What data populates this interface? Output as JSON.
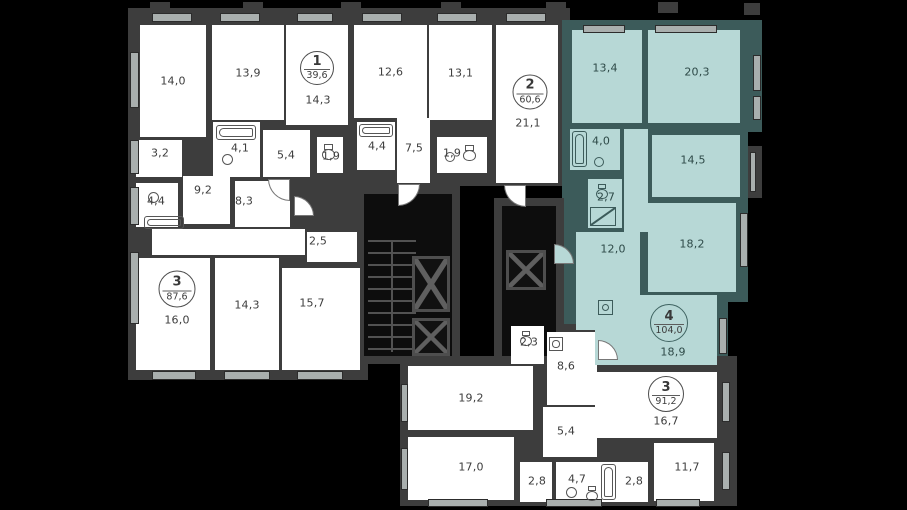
{
  "meta": {
    "description": "Residential floor plan with five apartments; apartment 4 (104.0 m2) highlighted"
  },
  "palette": {
    "background": "#000000",
    "wall": "#3d3d3d",
    "wall_teal": "#3c5b5a",
    "room_white": "#ffffff",
    "room_teal": "#b7d8d6",
    "label_text": "#3d3d3d",
    "label_text_teal": "#2e4a48",
    "window_mark": "#a9afae"
  },
  "units": [
    {
      "number": "1",
      "area": "39,6",
      "cx": 317,
      "cy": 68,
      "d": 34,
      "fill": "white"
    },
    {
      "number": "2",
      "area": "60,6",
      "cx": 530,
      "cy": 92,
      "d": 35,
      "fill": "white"
    },
    {
      "number": "3",
      "area": "87,6",
      "cx": 177,
      "cy": 289,
      "d": 37,
      "fill": "white"
    },
    {
      "number": "4",
      "area": "104,0",
      "cx": 669,
      "cy": 323,
      "d": 38,
      "fill": "teal"
    },
    {
      "number": "3",
      "area": "91,2",
      "cx": 666,
      "cy": 394,
      "d": 36,
      "fill": "white"
    }
  ],
  "rooms": [
    {
      "label": "14,0",
      "x": 140,
      "y": 25,
      "w": 66,
      "h": 112,
      "fill": "white"
    },
    {
      "label": "13,9",
      "x": 212,
      "y": 25,
      "w": 72,
      "h": 95,
      "fill": "white"
    },
    {
      "label": "14,3",
      "x": 286,
      "y": 25,
      "w": 62,
      "h": 100,
      "fill": "white",
      "lx": 318,
      "ly": 100
    },
    {
      "label": "12,6",
      "x": 354,
      "y": 25,
      "w": 73,
      "h": 93,
      "fill": "white"
    },
    {
      "label": "13,1",
      "x": 429,
      "y": 25,
      "w": 63,
      "h": 95,
      "fill": "white"
    },
    {
      "label": "21,1",
      "x": 496,
      "y": 25,
      "w": 62,
      "h": 158,
      "fill": "white",
      "lx": 528,
      "ly": 123
    },
    {
      "label": "3,2",
      "x": 136,
      "y": 140,
      "w": 46,
      "h": 37,
      "fill": "white",
      "lx": 160,
      "ly": 153
    },
    {
      "label": "4,1",
      "x": 213,
      "y": 122,
      "w": 47,
      "h": 55,
      "fill": "white",
      "lx": 240,
      "ly": 148
    },
    {
      "label": "5,4",
      "x": 263,
      "y": 130,
      "w": 47,
      "h": 47,
      "fill": "white",
      "lx": 286,
      "ly": 155
    },
    {
      "label": "1,9",
      "x": 317,
      "y": 137,
      "w": 26,
      "h": 36,
      "fill": "white",
      "lx": 331,
      "ly": 156
    },
    {
      "label": "4,4",
      "x": 357,
      "y": 122,
      "w": 38,
      "h": 48,
      "fill": "white",
      "lx": 377,
      "ly": 146
    },
    {
      "label": "7,5",
      "x": 397,
      "y": 118,
      "w": 33,
      "h": 65,
      "fill": "white",
      "lx": 414,
      "ly": 148
    },
    {
      "label": "1,9",
      "x": 437,
      "y": 137,
      "w": 50,
      "h": 36,
      "fill": "white",
      "lx": 452,
      "ly": 153
    },
    {
      "label": "4,4",
      "x": 136,
      "y": 183,
      "w": 42,
      "h": 44,
      "fill": "white",
      "lx": 156,
      "ly": 201
    },
    {
      "label": "9,2",
      "x": 183,
      "y": 176,
      "w": 47,
      "h": 48,
      "fill": "white",
      "lx": 203,
      "ly": 190
    },
    {
      "label": "8,3",
      "x": 235,
      "y": 181,
      "w": 55,
      "h": 46,
      "fill": "white",
      "lx": 244,
      "ly": 201
    },
    {
      "label": "",
      "x": 152,
      "y": 229,
      "w": 153,
      "h": 26,
      "fill": "white"
    },
    {
      "label": "2,5",
      "x": 307,
      "y": 232,
      "w": 50,
      "h": 30,
      "fill": "white",
      "lx": 318,
      "ly": 241
    },
    {
      "label": "16,0",
      "x": 136,
      "y": 258,
      "w": 74,
      "h": 112,
      "fill": "white",
      "lx": 177,
      "ly": 320
    },
    {
      "label": "14,3",
      "x": 215,
      "y": 258,
      "w": 64,
      "h": 112,
      "fill": "white",
      "lx": 247,
      "ly": 305
    },
    {
      "label": "15,7",
      "x": 282,
      "y": 268,
      "w": 78,
      "h": 102,
      "fill": "white",
      "lx": 312,
      "ly": 303
    },
    {
      "label": "2,3",
      "x": 511,
      "y": 326,
      "w": 33,
      "h": 38,
      "fill": "white",
      "lx": 529,
      "ly": 342
    },
    {
      "label": "8,6",
      "x": 547,
      "y": 332,
      "w": 50,
      "h": 73,
      "fill": "white",
      "lx": 566,
      "ly": 366
    },
    {
      "label": "19,2",
      "x": 408,
      "y": 366,
      "w": 125,
      "h": 64,
      "fill": "white",
      "lx": 471,
      "ly": 398
    },
    {
      "label": "5,4",
      "x": 543,
      "y": 407,
      "w": 54,
      "h": 50,
      "fill": "white",
      "lx": 566,
      "ly": 431
    },
    {
      "label": "16,7",
      "x": 595,
      "y": 372,
      "w": 122,
      "h": 66,
      "fill": "white",
      "lx": 666,
      "ly": 421
    },
    {
      "label": "17,0",
      "x": 408,
      "y": 437,
      "w": 106,
      "h": 63,
      "fill": "white",
      "lx": 471,
      "ly": 467
    },
    {
      "label": "2,8",
      "x": 520,
      "y": 462,
      "w": 32,
      "h": 40,
      "fill": "white",
      "lx": 537,
      "ly": 481
    },
    {
      "label": "4,7",
      "x": 556,
      "y": 462,
      "w": 62,
      "h": 40,
      "fill": "white",
      "lx": 577,
      "ly": 479
    },
    {
      "label": "2,8",
      "x": 618,
      "y": 462,
      "w": 30,
      "h": 40,
      "fill": "white",
      "lx": 634,
      "ly": 481
    },
    {
      "label": "11,7",
      "x": 654,
      "y": 443,
      "w": 60,
      "h": 58,
      "fill": "white",
      "lx": 687,
      "ly": 467
    },
    {
      "label": "13,4",
      "x": 572,
      "y": 30,
      "w": 70,
      "h": 93,
      "fill": "teal",
      "lx": 605,
      "ly": 68
    },
    {
      "label": "20,3",
      "x": 648,
      "y": 30,
      "w": 92,
      "h": 93,
      "fill": "teal",
      "lx": 697,
      "ly": 72
    },
    {
      "label": "4,0",
      "x": 570,
      "y": 129,
      "w": 50,
      "h": 41,
      "fill": "teal",
      "lx": 601,
      "ly": 141
    },
    {
      "label": "14,5",
      "x": 652,
      "y": 135,
      "w": 88,
      "h": 62,
      "fill": "teal",
      "lx": 693,
      "ly": 160
    },
    {
      "label": "",
      "x": 624,
      "y": 129,
      "w": 24,
      "h": 103,
      "fill": "teal"
    },
    {
      "label": "2,7",
      "x": 588,
      "y": 179,
      "w": 34,
      "h": 49,
      "fill": "teal",
      "lx": 606,
      "ly": 197
    },
    {
      "label": "12,0",
      "x": 576,
      "y": 232,
      "w": 64,
      "h": 98,
      "fill": "teal",
      "lx": 613,
      "ly": 249
    },
    {
      "label": "18,2",
      "x": 648,
      "y": 203,
      "w": 88,
      "h": 89,
      "fill": "teal",
      "lx": 692,
      "ly": 244
    },
    {
      "label": "18,9",
      "x": 595,
      "y": 295,
      "w": 122,
      "h": 70,
      "fill": "teal",
      "lx": 673,
      "ly": 352
    }
  ],
  "slabs": [
    {
      "x": 128,
      "y": 8,
      "w": 442,
      "h": 178,
      "fill": "wall"
    },
    {
      "x": 128,
      "y": 172,
      "w": 240,
      "h": 208,
      "fill": "wall"
    },
    {
      "x": 562,
      "y": 20,
      "w": 200,
      "h": 112,
      "fill": "teal"
    },
    {
      "x": 562,
      "y": 130,
      "w": 186,
      "h": 172,
      "fill": "teal"
    },
    {
      "x": 562,
      "y": 295,
      "w": 166,
      "h": 82,
      "fill": "teal"
    },
    {
      "x": 503,
      "y": 324,
      "w": 100,
      "h": 60,
      "fill": "wall"
    },
    {
      "x": 400,
      "y": 356,
      "w": 337,
      "h": 150,
      "fill": "wall"
    },
    {
      "x": 748,
      "y": 146,
      "w": 14,
      "h": 52,
      "fill": "wall"
    },
    {
      "x": 150,
      "y": 2,
      "w": 20,
      "h": 11,
      "fill": "wall"
    },
    {
      "x": 243,
      "y": 2,
      "w": 20,
      "h": 11,
      "fill": "wall"
    },
    {
      "x": 341,
      "y": 2,
      "w": 20,
      "h": 11,
      "fill": "wall"
    },
    {
      "x": 441,
      "y": 2,
      "w": 20,
      "h": 11,
      "fill": "wall"
    },
    {
      "x": 546,
      "y": 2,
      "w": 20,
      "h": 11,
      "fill": "wall"
    },
    {
      "x": 658,
      "y": 2,
      "w": 20,
      "h": 11,
      "fill": "wall"
    },
    {
      "x": 744,
      "y": 3,
      "w": 16,
      "h": 12,
      "fill": "wall"
    }
  ],
  "core": {
    "walls": [
      {
        "x": 356,
        "y": 186,
        "w": 104,
        "h": 178
      },
      {
        "x": 494,
        "y": 198,
        "w": 70,
        "h": 166
      }
    ],
    "inners": [
      {
        "x": 364,
        "y": 194,
        "w": 88,
        "h": 162
      },
      {
        "x": 502,
        "y": 206,
        "w": 54,
        "h": 150
      }
    ],
    "treads": {
      "x": 368,
      "y": 240,
      "w": 48,
      "h": 112
    },
    "tread_divider": {
      "x": 391,
      "y": 240,
      "w": 2,
      "h": 112
    },
    "elevators": [
      {
        "x": 412,
        "y": 256,
        "w": 38,
        "h": 56
      },
      {
        "x": 412,
        "y": 318,
        "w": 38,
        "h": 38
      },
      {
        "x": 506,
        "y": 250,
        "w": 40,
        "h": 40
      }
    ]
  },
  "windows": [
    {
      "x": 152,
      "y": 13,
      "w": 40,
      "h": 9
    },
    {
      "x": 220,
      "y": 13,
      "w": 40,
      "h": 9
    },
    {
      "x": 297,
      "y": 13,
      "w": 36,
      "h": 9
    },
    {
      "x": 362,
      "y": 13,
      "w": 40,
      "h": 9
    },
    {
      "x": 437,
      "y": 13,
      "w": 40,
      "h": 9
    },
    {
      "x": 506,
      "y": 13,
      "w": 40,
      "h": 9
    },
    {
      "x": 583,
      "y": 25,
      "w": 42,
      "h": 8
    },
    {
      "x": 655,
      "y": 25,
      "w": 62,
      "h": 8
    },
    {
      "x": 130,
      "y": 52,
      "w": 9,
      "h": 56
    },
    {
      "x": 130,
      "y": 140,
      "w": 9,
      "h": 34
    },
    {
      "x": 130,
      "y": 187,
      "w": 9,
      "h": 38
    },
    {
      "x": 130,
      "y": 252,
      "w": 9,
      "h": 72
    },
    {
      "x": 152,
      "y": 371,
      "w": 44,
      "h": 9
    },
    {
      "x": 224,
      "y": 371,
      "w": 46,
      "h": 9
    },
    {
      "x": 297,
      "y": 371,
      "w": 46,
      "h": 9
    },
    {
      "x": 753,
      "y": 55,
      "w": 8,
      "h": 36
    },
    {
      "x": 753,
      "y": 96,
      "w": 8,
      "h": 24
    },
    {
      "x": 740,
      "y": 213,
      "w": 8,
      "h": 54
    },
    {
      "x": 719,
      "y": 318,
      "w": 8,
      "h": 36
    },
    {
      "x": 750,
      "y": 152,
      "w": 6,
      "h": 40
    },
    {
      "x": 401,
      "y": 384,
      "w": 7,
      "h": 38
    },
    {
      "x": 401,
      "y": 448,
      "w": 7,
      "h": 42
    },
    {
      "x": 428,
      "y": 499,
      "w": 60,
      "h": 8
    },
    {
      "x": 546,
      "y": 499,
      "w": 56,
      "h": 8
    },
    {
      "x": 656,
      "y": 499,
      "w": 44,
      "h": 8
    },
    {
      "x": 722,
      "y": 382,
      "w": 8,
      "h": 40
    },
    {
      "x": 722,
      "y": 452,
      "w": 8,
      "h": 38
    }
  ],
  "doors": [
    {
      "x": 268,
      "y": 179,
      "s": 22,
      "corner": "bl",
      "fill": "white"
    },
    {
      "x": 398,
      "y": 184,
      "s": 22,
      "corner": "br",
      "fill": "white"
    },
    {
      "x": 504,
      "y": 185,
      "s": 22,
      "corner": "bl",
      "fill": "white"
    },
    {
      "x": 294,
      "y": 196,
      "s": 20,
      "corner": "tr",
      "fill": "white"
    },
    {
      "x": 554,
      "y": 244,
      "s": 20,
      "corner": "tr",
      "fill": "teal"
    },
    {
      "x": 598,
      "y": 340,
      "s": 20,
      "corner": "tr",
      "fill": "white"
    }
  ],
  "fixtures": [
    {
      "type": "tub-h",
      "x": 216,
      "y": 125,
      "w": 40,
      "h": 15,
      "fill": "white"
    },
    {
      "type": "tub-h",
      "x": 359,
      "y": 124,
      "w": 34,
      "h": 13,
      "fill": "white"
    },
    {
      "type": "tub-h",
      "x": 144,
      "y": 216,
      "w": 40,
      "h": 13,
      "fill": "white"
    },
    {
      "type": "tub-v",
      "x": 572,
      "y": 131,
      "w": 15,
      "h": 36,
      "fill": "teal"
    },
    {
      "type": "tub-v",
      "x": 601,
      "y": 464,
      "w": 15,
      "h": 36,
      "fill": "white"
    },
    {
      "type": "sink",
      "x": 222,
      "y": 154,
      "w": 11,
      "h": 11,
      "fill": "white"
    },
    {
      "type": "sink",
      "x": 148,
      "y": 192,
      "w": 11,
      "h": 11,
      "fill": "white"
    },
    {
      "type": "sink",
      "x": 594,
      "y": 157,
      "w": 10,
      "h": 10,
      "fill": "teal"
    },
    {
      "type": "sink",
      "x": 566,
      "y": 487,
      "w": 11,
      "h": 11,
      "fill": "white"
    },
    {
      "type": "sink",
      "x": 445,
      "y": 152,
      "w": 10,
      "h": 10,
      "fill": "white"
    },
    {
      "type": "toilet",
      "x": 322,
      "y": 144,
      "w": 13,
      "h": 16,
      "fill": "white"
    },
    {
      "type": "toilet",
      "x": 463,
      "y": 145,
      "w": 13,
      "h": 16,
      "fill": "white"
    },
    {
      "type": "toilet",
      "x": 596,
      "y": 184,
      "w": 12,
      "h": 15,
      "fill": "teal"
    },
    {
      "type": "toilet",
      "x": 520,
      "y": 331,
      "w": 12,
      "h": 15,
      "fill": "white"
    },
    {
      "type": "toilet",
      "x": 586,
      "y": 486,
      "w": 12,
      "h": 15,
      "fill": "white"
    },
    {
      "type": "shower",
      "x": 590,
      "y": 207,
      "w": 26,
      "h": 19,
      "fill": "teal"
    },
    {
      "type": "washer",
      "x": 549,
      "y": 337,
      "w": 14,
      "h": 14,
      "fill": "white"
    },
    {
      "type": "washer",
      "x": 598,
      "y": 300,
      "w": 15,
      "h": 15,
      "fill": "teal"
    }
  ]
}
